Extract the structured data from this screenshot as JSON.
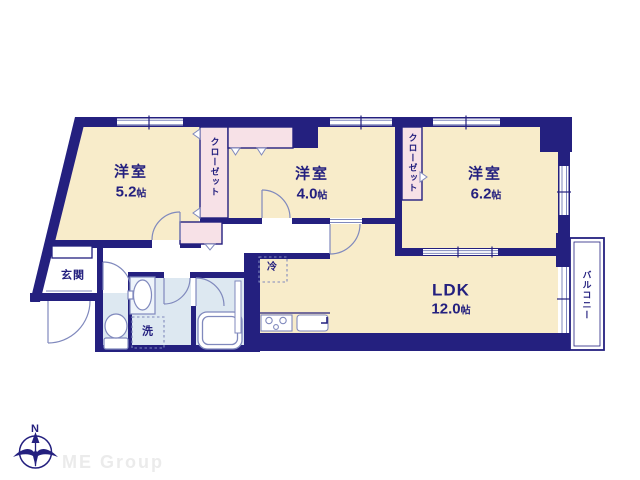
{
  "plan": {
    "rooms": {
      "room_5_2": {
        "name": "洋室",
        "size": "5.2",
        "unit": "帖"
      },
      "room_4_0": {
        "name": "洋室",
        "size": "4.0",
        "unit": "帖"
      },
      "room_6_2": {
        "name": "洋室",
        "size": "6.2",
        "unit": "帖"
      },
      "ldk": {
        "name": "LDK",
        "size": "12.0",
        "unit": "帖"
      }
    },
    "labels": {
      "closet_1": "クローゼット",
      "closet_2": "クローゼット",
      "entrance": "玄関",
      "laundry": "洗",
      "refrigerator": "冷",
      "balcony": "バルコニー"
    },
    "compass": {
      "north": "N"
    }
  },
  "footer": {
    "brand": "ME Group"
  },
  "colors": {
    "wall": "#24207f",
    "room_floor": "#f8ecca",
    "closet_floor": "#f7e1e7",
    "wet_floor": "#dde8f1",
    "detail_line": "#8089bd",
    "brand_text": "#ebebeb"
  }
}
